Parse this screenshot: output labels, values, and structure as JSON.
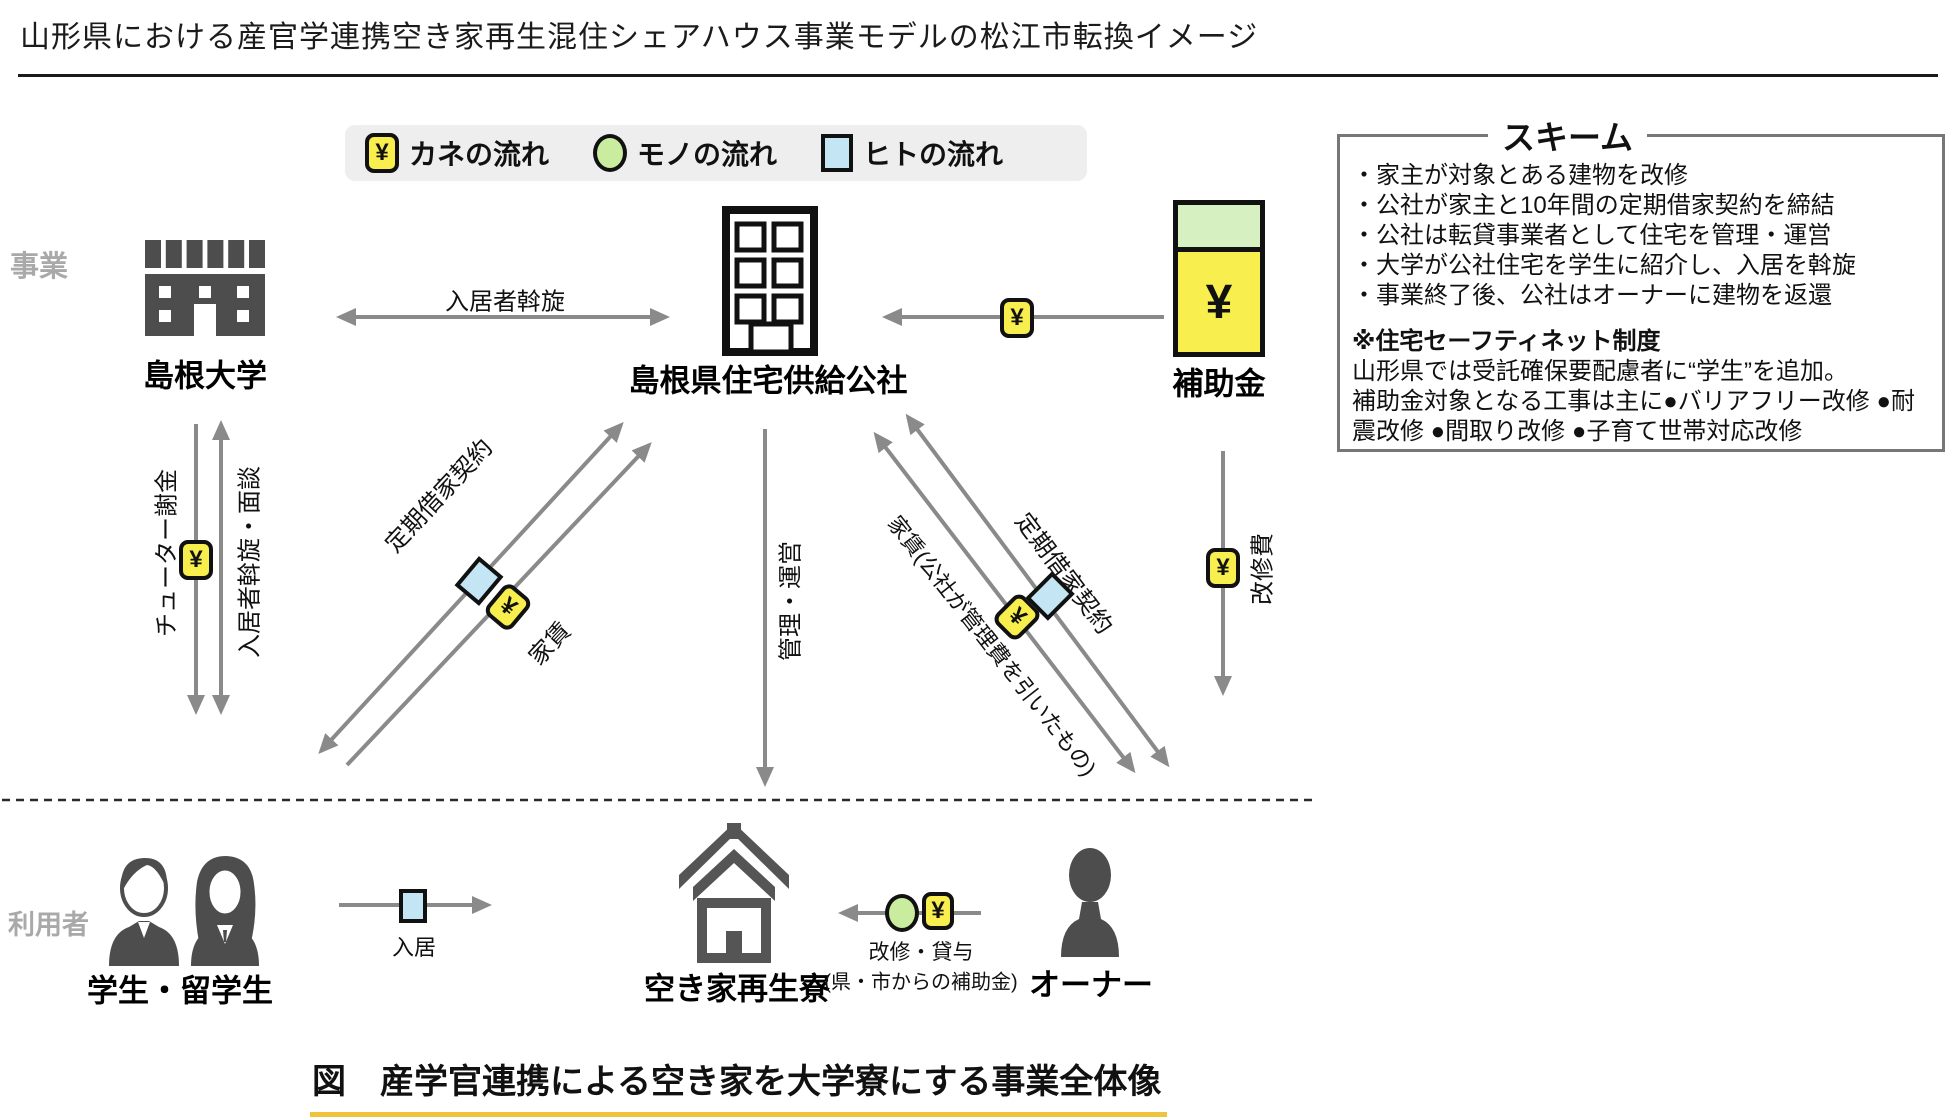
{
  "title": "山形県における産官学連携空き家再生混住シェアハウス事業モデルの松江市転換イメージ",
  "symbols": {
    "yen": "¥"
  },
  "legend": {
    "money_label": "カネの流れ",
    "goods_label": "モノの流れ",
    "people_label": "ヒトの流れ"
  },
  "row_labels": {
    "business": "事業",
    "users": "利用者"
  },
  "entities": {
    "university": "島根大学",
    "corporation": "島根県住宅供給公社",
    "subsidy": "補助金",
    "students": "学生・留学生",
    "dorm": "空き家再生寮",
    "owner": "オーナー"
  },
  "flows": {
    "tenant_referral": "入居者斡旋",
    "tutor_fee": "チューター謝金",
    "referral_interview": "入居者斡旋・面談",
    "fixed_term_lease_left": "定期借家契約",
    "rent_left": "家賃",
    "management_operation": "管理・運営",
    "rent_to_owner": "家賃(公社が管理費を引いたもの)",
    "fixed_term_lease_right": "定期借家契約",
    "renovation_cost": "改修費",
    "move_in": "入居",
    "renovation_lending": "改修・貸与",
    "renovation_lending_note": "(県・市からの補助金)"
  },
  "scheme": {
    "title": "スキーム",
    "items": [
      "・家主が対象とある建物を改修",
      "・公社が家主と10年間の定期借家契約を締結",
      "・公社は転貸事業者として住宅を管理・運営",
      "・大学が公社住宅を学生に紹介し、入居を斡旋",
      "・事業終了後、公社はオーナーに建物を返還"
    ],
    "note_title": "※住宅セーフティネット制度",
    "note_line1": "山形県では受託確保要配慮者に“学生”を追加。",
    "note_line2": "補助金対象となる工事は主に●バリアフリー改修 ●耐震改修 ●間取り改修 ●子育て世帯対応改修"
  },
  "caption": "図　産学官連携による空き家を大学寮にする事業全体像",
  "colors": {
    "money_yellow": "#F8EE4D",
    "goods_green": "#C9EC9F",
    "people_blue": "#C3E5F4",
    "subsidy_green_top": "#D6F0C2",
    "arrow_gray": "#8A8A8A",
    "caption_underline": "#F0C33C"
  }
}
